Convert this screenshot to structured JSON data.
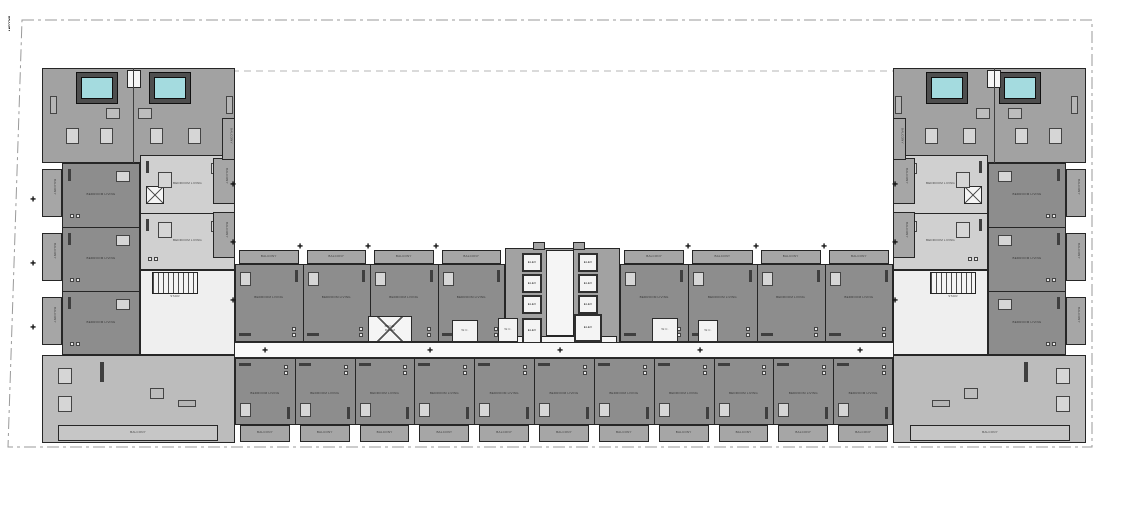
{
  "drawing": {
    "kind": "architectural floor plan",
    "shape": "U-shaped residential tower typical floor"
  },
  "labels": {
    "balcony": "BALCONY",
    "elevator": "ELEV",
    "stair": "STAIR",
    "mech_line1": "MECH.",
    "mech_line2": "ROOM",
    "unit": "BEDROOM LIVING",
    "service": "W.C.",
    "marker_glyph": "✚"
  },
  "colors": {
    "unit": "#8d8d8d",
    "unit_light": "#d0d0d0",
    "penthouse": "#a2a2a2",
    "corner": "#bcbcbc",
    "balcony": "#a6a6a6",
    "balcony_light": "#c6c6c6",
    "white_area": "#efefef",
    "wall": "#262626",
    "water": "#a4dbdf",
    "deck": "#4e4e4e",
    "dash": "#9a9a9a",
    "furn_dark": "#3f3f3f",
    "furn_light": "#d6d6d6"
  },
  "site": {
    "outline": [
      [
        22,
        20
      ],
      [
        1092,
        20
      ],
      [
        1092,
        447
      ],
      [
        8,
        447
      ]
    ],
    "overhang_line": {
      "y": 71,
      "x1": 232,
      "x2": 895
    }
  },
  "blocks": [
    {
      "id": "penthouse-left",
      "x": 42,
      "y": 68,
      "w": 193,
      "h": 95,
      "fill": "penthouse"
    },
    {
      "id": "penthouse-right",
      "x": 893,
      "y": 68,
      "w": 193,
      "h": 95,
      "fill": "penthouse"
    },
    {
      "id": "junction-left",
      "x": 140,
      "y": 270,
      "w": 95,
      "h": 85,
      "fill": "white_area"
    },
    {
      "id": "junction-right",
      "x": 893,
      "y": 270,
      "w": 95,
      "h": 85,
      "fill": "white_area"
    },
    {
      "id": "corner-unit-left",
      "x": 42,
      "y": 355,
      "w": 193,
      "h": 88,
      "fill": "corner"
    },
    {
      "id": "corner-unit-right",
      "x": 893,
      "y": 355,
      "w": 193,
      "h": 88,
      "fill": "corner"
    },
    {
      "id": "elevator-core",
      "x": 505,
      "y": 248,
      "w": 115,
      "h": 104,
      "fill": "penthouse"
    }
  ],
  "rows": [
    {
      "id": "bar-upper-left",
      "x": 235,
      "y": 264,
      "w": 270,
      "h": 78,
      "count": 4,
      "balcony": "top",
      "fill": "unit",
      "vertical": false
    },
    {
      "id": "bar-upper-right",
      "x": 620,
      "y": 264,
      "w": 273,
      "h": 78,
      "count": 4,
      "balcony": "top",
      "fill": "unit",
      "vertical": false
    },
    {
      "id": "bar-lower",
      "x": 235,
      "y": 358,
      "w": 658,
      "h": 67,
      "count": 11,
      "balcony": "bottom",
      "fill": "unit",
      "vertical": false
    },
    {
      "id": "wing-left",
      "x": 62,
      "y": 163,
      "w": 78,
      "h": 192,
      "count": 3,
      "balcony": "left",
      "fill": "unit",
      "vertical": true,
      "inner": "right"
    },
    {
      "id": "wing-right",
      "x": 988,
      "y": 163,
      "w": 78,
      "h": 192,
      "count": 3,
      "balcony": "right",
      "fill": "unit",
      "vertical": true,
      "inner": "left"
    },
    {
      "id": "inner-units-left",
      "x": 140,
      "y": 155,
      "w": 95,
      "h": 115,
      "count": 2,
      "balcony": "none",
      "fill": "unit_light",
      "vertical": true,
      "inner": "right"
    },
    {
      "id": "inner-units-right",
      "x": 893,
      "y": 155,
      "w": 95,
      "h": 115,
      "count": 2,
      "balcony": "none",
      "fill": "unit_light",
      "vertical": true,
      "inner": "left"
    }
  ],
  "balconies_abs": [
    [
      213,
      158,
      22,
      46
    ],
    [
      213,
      212,
      22,
      46
    ],
    [
      893,
      158,
      22,
      46
    ],
    [
      893,
      212,
      22,
      46
    ],
    [
      222,
      118,
      13,
      42
    ],
    [
      893,
      118,
      13,
      42
    ],
    [
      58,
      425,
      160,
      16
    ],
    [
      910,
      425,
      160,
      16
    ]
  ],
  "pools": [
    [
      76,
      72,
      42,
      32
    ],
    [
      149,
      72,
      42,
      32
    ],
    [
      926,
      72,
      42,
      32
    ],
    [
      999,
      72,
      42,
      32
    ]
  ],
  "shafts": [
    [
      127,
      70,
      14,
      18
    ],
    [
      987,
      70,
      14,
      18
    ]
  ],
  "core": {
    "cabs": [
      [
        522,
        253,
        20,
        19
      ],
      [
        522,
        274,
        20,
        19
      ],
      [
        522,
        295,
        20,
        19
      ],
      [
        522,
        318,
        20,
        26
      ],
      [
        578,
        253,
        20,
        19
      ],
      [
        578,
        274,
        20,
        19
      ],
      [
        578,
        295,
        20,
        19
      ],
      [
        574,
        314,
        28,
        28
      ]
    ],
    "lobby": [
      [
        546,
        250,
        28,
        86
      ],
      [
        508,
        336,
        109,
        16
      ]
    ],
    "stubs": [
      [
        533,
        242,
        12,
        8
      ],
      [
        573,
        242,
        12,
        8
      ]
    ]
  },
  "corridor": {
    "x": 235,
    "y": 342,
    "w": 658,
    "h": 16
  },
  "stairs": [
    [
      152,
      272,
      46,
      22
    ],
    [
      930,
      272,
      46,
      22
    ]
  ],
  "xrooms": [
    [
      146,
      186,
      18,
      18
    ],
    [
      964,
      186,
      18,
      18
    ]
  ],
  "mech_room": {
    "x": 368,
    "y": 316,
    "w": 44,
    "h": 26
  },
  "service_rooms": [
    [
      452,
      320,
      26,
      22
    ],
    [
      498,
      318,
      20,
      24
    ],
    [
      652,
      318,
      26,
      24
    ],
    [
      698,
      320,
      20,
      22
    ]
  ],
  "furniture": {
    "tables": [
      [
        106,
        108,
        14,
        11
      ],
      [
        138,
        108,
        14,
        11
      ],
      [
        976,
        108,
        14,
        11
      ],
      [
        1008,
        108,
        14,
        11
      ],
      [
        150,
        388,
        14,
        11
      ],
      [
        964,
        388,
        14,
        11
      ]
    ],
    "sofas": [
      [
        50,
        96,
        7,
        18
      ],
      [
        226,
        96,
        7,
        18
      ],
      [
        895,
        96,
        7,
        18
      ],
      [
        1071,
        96,
        7,
        18
      ],
      [
        178,
        400,
        18,
        7
      ],
      [
        932,
        400,
        18,
        7
      ]
    ],
    "beds": [
      [
        66,
        128,
        13,
        16
      ],
      [
        100,
        128,
        13,
        16
      ],
      [
        150,
        128,
        13,
        16
      ],
      [
        188,
        128,
        13,
        16
      ],
      [
        925,
        128,
        13,
        16
      ],
      [
        963,
        128,
        13,
        16
      ],
      [
        1015,
        128,
        13,
        16
      ],
      [
        1049,
        128,
        13,
        16
      ],
      [
        58,
        368,
        14,
        16
      ],
      [
        58,
        396,
        14,
        16
      ],
      [
        1056,
        368,
        14,
        16
      ],
      [
        1056,
        396,
        14,
        16
      ],
      [
        158,
        172,
        14,
        16
      ],
      [
        158,
        222,
        14,
        16
      ],
      [
        956,
        172,
        14,
        16
      ],
      [
        956,
        222,
        14,
        16
      ]
    ],
    "strips": [
      [
        100,
        362,
        4,
        20
      ],
      [
        1024,
        362,
        4,
        20
      ],
      [
        133,
        68,
        1,
        95
      ],
      [
        994,
        68,
        1,
        95
      ]
    ]
  },
  "markers": [
    [
      300,
      247
    ],
    [
      368,
      247
    ],
    [
      436,
      247
    ],
    [
      688,
      247
    ],
    [
      756,
      247
    ],
    [
      824,
      247
    ],
    [
      265,
      351
    ],
    [
      430,
      351
    ],
    [
      560,
      351
    ],
    [
      700,
      351
    ],
    [
      860,
      351
    ],
    [
      233,
      185
    ],
    [
      233,
      243
    ],
    [
      233,
      301
    ],
    [
      895,
      185
    ],
    [
      895,
      243
    ],
    [
      895,
      301
    ],
    [
      33,
      200
    ],
    [
      33,
      264
    ],
    [
      33,
      328
    ]
  ]
}
